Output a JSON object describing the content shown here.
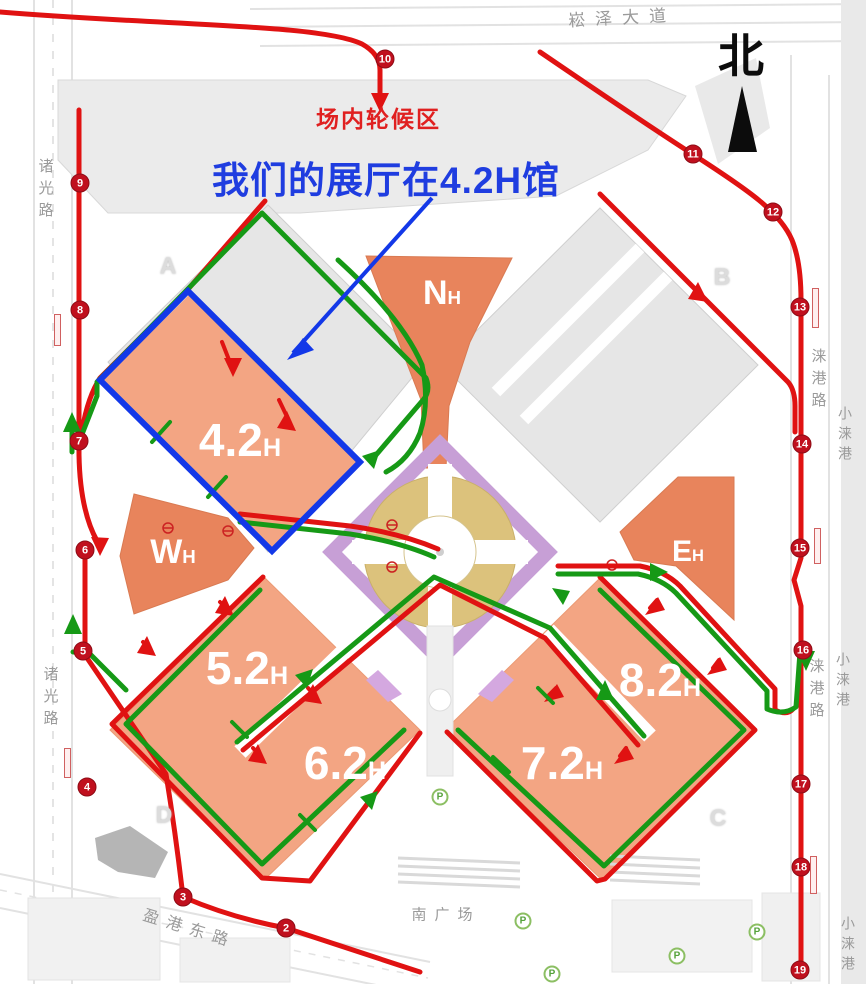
{
  "annotations": {
    "headline": "我们的展厅在4.2H馆",
    "waiting_area_label": "场内轮候区",
    "compass_north": "北"
  },
  "colors": {
    "hall_orange": "#f3a583",
    "hall_dark_orange": "#e8845c",
    "route_red": "#e01212",
    "route_green": "#169916",
    "highlight_blue": "#1338e8",
    "stop_red": "#c0101e",
    "ring_gold": "#dcc27c",
    "corridor_purple": "#c79fd6",
    "annotation_blue": "#1f3de0",
    "annotation_red": "#e02020"
  },
  "halls": [
    {
      "id": "4-2h",
      "label": "4.2",
      "sub": "H",
      "x": 240,
      "y": 440,
      "size": 46,
      "highlighted": true
    },
    {
      "id": "5-2h",
      "label": "5.2",
      "sub": "H",
      "x": 247,
      "y": 668,
      "size": 46,
      "highlighted": false
    },
    {
      "id": "6-2h",
      "label": "6.2",
      "sub": "H",
      "x": 345,
      "y": 763,
      "size": 46,
      "highlighted": false
    },
    {
      "id": "7-2h",
      "label": "7.2",
      "sub": "H",
      "x": 562,
      "y": 763,
      "size": 46,
      "highlighted": false
    },
    {
      "id": "8-2h",
      "label": "8.2",
      "sub": "H",
      "x": 660,
      "y": 680,
      "size": 46,
      "highlighted": false
    },
    {
      "id": "nh",
      "label": "N",
      "sub": "H",
      "x": 442,
      "y": 293,
      "size": 34,
      "highlighted": false
    },
    {
      "id": "wh",
      "label": "W",
      "sub": "H",
      "x": 173,
      "y": 552,
      "size": 34,
      "highlighted": false
    },
    {
      "id": "eh",
      "label": "E",
      "sub": "H",
      "x": 688,
      "y": 552,
      "size": 30,
      "highlighted": false
    }
  ],
  "zones": [
    {
      "label": "A",
      "x": 168,
      "y": 266
    },
    {
      "label": "B",
      "x": 722,
      "y": 277
    },
    {
      "label": "C",
      "x": 718,
      "y": 818
    },
    {
      "label": "D",
      "x": 164,
      "y": 815
    }
  ],
  "roads": [
    {
      "text": "崧泽大道",
      "x": 622,
      "y": 16,
      "dir": "h",
      "rot": -3,
      "ls": 10,
      "size": 17
    },
    {
      "text": "诸光路",
      "x": 45,
      "y": 158,
      "dir": "v",
      "rot": 0,
      "ls": 7,
      "size": 15
    },
    {
      "text": "诸光路",
      "x": 50,
      "y": 666,
      "dir": "v",
      "rot": 0,
      "ls": 7,
      "size": 15
    },
    {
      "text": "涞港路",
      "x": 818,
      "y": 348,
      "dir": "v",
      "rot": 0,
      "ls": 7,
      "size": 15
    },
    {
      "text": "小涞港",
      "x": 845,
      "y": 406,
      "dir": "v",
      "rot": 0,
      "ls": 6,
      "size": 14
    },
    {
      "text": "涞港路",
      "x": 816,
      "y": 658,
      "dir": "v",
      "rot": 0,
      "ls": 7,
      "size": 15
    },
    {
      "text": "小涞港",
      "x": 843,
      "y": 652,
      "dir": "v",
      "rot": 0,
      "ls": 6,
      "size": 14
    },
    {
      "text": "小涞港",
      "x": 848,
      "y": 916,
      "dir": "v",
      "rot": 0,
      "ls": 6,
      "size": 14
    },
    {
      "text": "盈港东路",
      "x": 190,
      "y": 927,
      "dir": "h",
      "rot": 17,
      "ls": 8,
      "size": 16
    },
    {
      "text": "南广场",
      "x": 446,
      "y": 914,
      "dir": "h",
      "rot": 0,
      "ls": 8,
      "size": 15
    }
  ],
  "stops": [
    {
      "n": "2",
      "x": 286,
      "y": 928
    },
    {
      "n": "3",
      "x": 183,
      "y": 897
    },
    {
      "n": "4",
      "x": 87,
      "y": 787
    },
    {
      "n": "5",
      "x": 83,
      "y": 651
    },
    {
      "n": "6",
      "x": 85,
      "y": 550
    },
    {
      "n": "7",
      "x": 79,
      "y": 441
    },
    {
      "n": "8",
      "x": 80,
      "y": 310
    },
    {
      "n": "9",
      "x": 80,
      "y": 183
    },
    {
      "n": "10",
      "x": 385,
      "y": 59
    },
    {
      "n": "11",
      "x": 693,
      "y": 154
    },
    {
      "n": "12",
      "x": 773,
      "y": 212
    },
    {
      "n": "13",
      "x": 800,
      "y": 307
    },
    {
      "n": "14",
      "x": 802,
      "y": 444
    },
    {
      "n": "15",
      "x": 800,
      "y": 548
    },
    {
      "n": "16",
      "x": 803,
      "y": 650
    },
    {
      "n": "17",
      "x": 801,
      "y": 784
    },
    {
      "n": "18",
      "x": 801,
      "y": 867
    },
    {
      "n": "19",
      "x": 800,
      "y": 970
    }
  ],
  "parking": [
    {
      "label": "P",
      "x": 440,
      "y": 797
    },
    {
      "label": "P",
      "x": 523,
      "y": 921
    },
    {
      "label": "P",
      "x": 552,
      "y": 974
    },
    {
      "label": "P",
      "x": 677,
      "y": 956
    },
    {
      "label": "P",
      "x": 757,
      "y": 932
    }
  ]
}
